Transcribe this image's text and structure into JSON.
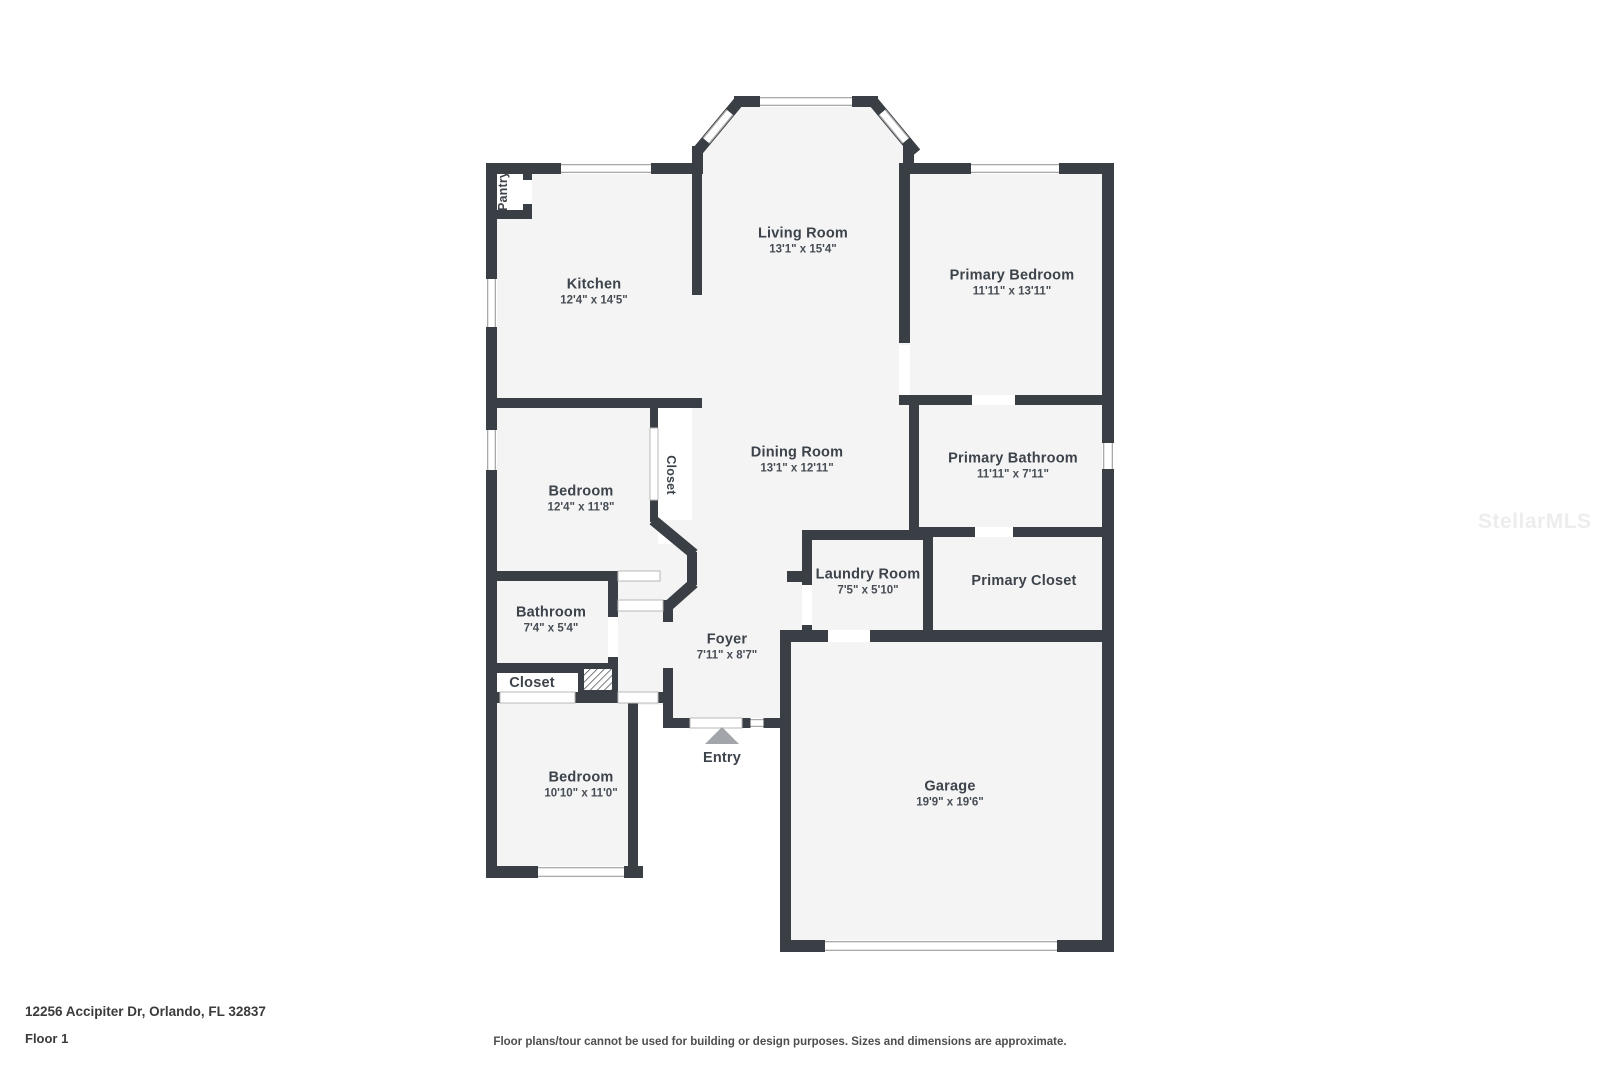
{
  "colors": {
    "wall": "#3a3f45",
    "floor": "#f4f4f4",
    "label_text": "#3d434b",
    "entry_arrow": "#a2a6ab",
    "window_line": "#a9a9a9"
  },
  "rooms": [
    {
      "id": "pantry",
      "name": "Pantry"
    },
    {
      "id": "kitchen",
      "name": "Kitchen",
      "dims": "12'4\" x 14'5\""
    },
    {
      "id": "living-room",
      "name": "Living Room",
      "dims": "13'1\" x 15'4\""
    },
    {
      "id": "primary-bedroom",
      "name": "Primary Bedroom",
      "dims": "11'11\" x 13'11\""
    },
    {
      "id": "dining-room",
      "name": "Dining Room",
      "dims": "13'1\" x 12'11\""
    },
    {
      "id": "hall-closet",
      "name": "Closet"
    },
    {
      "id": "bedroom-mid",
      "name": "Bedroom",
      "dims": "12'4\" x 11'8\""
    },
    {
      "id": "primary-bathroom",
      "name": "Primary Bathroom",
      "dims": "11'11\" x 7'11\""
    },
    {
      "id": "laundry-room",
      "name": "Laundry Room",
      "dims": "7'5\" x 5'10\""
    },
    {
      "id": "primary-closet",
      "name": "Primary Closet"
    },
    {
      "id": "bathroom",
      "name": "Bathroom",
      "dims": "7'4\" x 5'4\""
    },
    {
      "id": "closet",
      "name": "Closet"
    },
    {
      "id": "foyer",
      "name": "Foyer",
      "dims": "7'11\" x 8'7\""
    },
    {
      "id": "entry",
      "name": "Entry"
    },
    {
      "id": "bedroom-bottom",
      "name": "Bedroom",
      "dims": "10'10\" x 11'0\""
    },
    {
      "id": "garage",
      "name": "Garage",
      "dims": "19'9\" x 19'6\""
    }
  ],
  "footer": {
    "address": "12256 Accipiter Dr, Orlando, FL 32837",
    "floor": "Floor 1",
    "disclaimer": "Floor plans/tour cannot be used for building or design purposes. Sizes and dimensions are approximate."
  },
  "watermark": "StellarMLS"
}
